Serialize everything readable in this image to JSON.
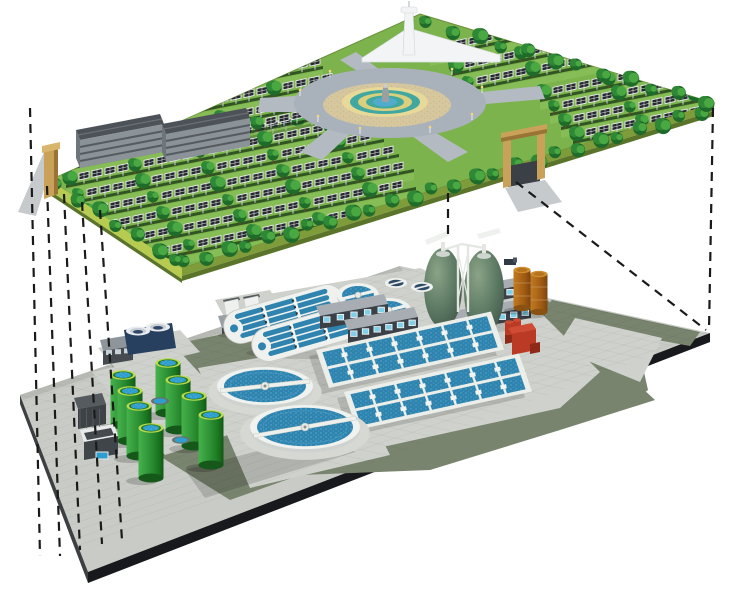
{
  "meta": {
    "description": "Isometric cutaway illustration: a solar park with trees, fountain plaza and greenhouses on an upper deck, with an underground wastewater treatment plant on a lower deck, linked by dashed projection lines",
    "text_content": "none - illustration contains no visible text"
  },
  "colors": {
    "sky": "#ffffff",
    "grass": "#7cb34c",
    "grassLight": "#90c55e",
    "rowShadow": "#1d3d18",
    "panel": "#25282e",
    "panelFrame": "#e9ebed",
    "post": "#cdd2d6",
    "treeDark": "#1e6b2a",
    "treeMid": "#2f8836",
    "treeLight": "#4aa843",
    "verge": "#a8c95e",
    "bevelLight": "#b7cb50",
    "bevelMid": "#7e9c3a",
    "bevelDark": "#5a7429",
    "plazaRing": "#a9b2bb",
    "path": "#b3bac1",
    "plazaTan": "#d6c79e",
    "plazaCream": "#e7d998",
    "plazaTeal": "#41a8a0",
    "plazaYellow": "#d9cf7d",
    "plazaBlue": "#52aacd",
    "fountainStone": "#9aa0a2",
    "roofDark": "#4c5257",
    "wallGray": "#8b9298",
    "windowBand": "#3a4045",
    "windowGlass": "#7fd0e8",
    "gateTan": "#c9a159",
    "gateTanDark": "#9a7436",
    "roadOut": "#c6cacd",
    "towerWhite": "#f2f4f5",
    "tile": "#c9ccc6",
    "road": "#79846f",
    "edgeBlack": "#17191c",
    "edgeGray": "#3c4043",
    "apron": "#cfd2cc",
    "curb": "#b7bab4",
    "white": "#eff1ee",
    "whiteShade": "#cfd3cf",
    "water": "#2e84ae",
    "waterDots": "#6db4d6",
    "waterDark": "#2f9ecf",
    "tankGreenRim": "#b9da4b",
    "tankInner": "#1f7a28",
    "tankBottom": "#15581a",
    "navy": "#27405f",
    "eggLight": "#8ba387",
    "egg": "#5d7a64",
    "eggDark": "#3f5546",
    "pipe": "#e3e7e2",
    "brown": "#aa6218",
    "brownDark": "#7c450e",
    "brownTop": "#cd8c2e",
    "red": "#bb3a26",
    "redDark": "#8f2a18",
    "redLight": "#d04b33",
    "shadow": "rgba(0,0,0,0.18)",
    "dash": "#1a1a1a"
  },
  "upper_deck": {
    "deck_polygon": [
      [
        50,
        180
      ],
      [
        420,
        14
      ],
      [
        714,
        103
      ],
      [
        182,
        268
      ]
    ],
    "solar_rows": [
      [
        128,
        96,
        195
      ],
      [
        140,
        112,
        200
      ],
      [
        152,
        128,
        205
      ],
      [
        164,
        144,
        210
      ],
      [
        430,
        46,
        175
      ],
      [
        452,
        64,
        175
      ],
      [
        464,
        80,
        180
      ],
      [
        58,
        160,
        300
      ],
      [
        66,
        176,
        305
      ],
      [
        74,
        192,
        310
      ],
      [
        84,
        208,
        315
      ],
      [
        94,
        224,
        320
      ],
      [
        106,
        240,
        310
      ],
      [
        120,
        256,
        240
      ],
      [
        540,
        90,
        168
      ],
      [
        550,
        104,
        166
      ],
      [
        561,
        118,
        160
      ],
      [
        573,
        132,
        148
      ],
      [
        340,
        226,
        130
      ]
    ],
    "row_slope": -0.2,
    "panel_spacing": 13,
    "tree_borders": [
      {
        "from": [
          186,
          263
        ],
        "to": [
          702,
          112
        ],
        "count": 26
      },
      {
        "from": [
          428,
          24
        ],
        "to": [
          704,
          102
        ],
        "count": 12
      },
      {
        "from": [
          58,
          186
        ],
        "to": [
          178,
          262
        ],
        "count": 7
      }
    ],
    "plaza": {
      "cx": 390,
      "cy": 103,
      "ring_rx": 96,
      "ring_ry": 35,
      "tan_rx": 64,
      "tan_ry": 22,
      "rings": [
        [
          43,
          15
        ],
        [
          35,
          12
        ],
        [
          27,
          9
        ],
        [
          19,
          6.5
        ],
        [
          12,
          4.5
        ]
      ],
      "lamps": [
        [
          300,
          96
        ],
        [
          318,
          122
        ],
        [
          360,
          134
        ],
        [
          430,
          133
        ],
        [
          472,
          120
        ],
        [
          482,
          93
        ],
        [
          452,
          75
        ],
        [
          330,
          77
        ]
      ]
    },
    "greenhouse_buildings": 2,
    "entrance_gates": 2,
    "observation_tower": true
  },
  "lower_deck": {
    "deck_polygon": [
      [
        20,
        395
      ],
      [
        400,
        266
      ],
      [
        710,
        333
      ],
      [
        88,
        572
      ]
    ],
    "green_tanks": [
      [
        168,
        363
      ],
      [
        123,
        375
      ],
      [
        178,
        380
      ],
      [
        130,
        391
      ],
      [
        194,
        396
      ],
      [
        139,
        406
      ],
      [
        211,
        415
      ],
      [
        151,
        428
      ]
    ],
    "clarifiers": [
      [
        265,
        386,
        48,
        19,
        -6
      ],
      [
        305,
        427,
        55,
        22,
        -10
      ]
    ],
    "oxidation_ditches": [
      [
        284,
        314,
        -16
      ],
      [
        312,
        332,
        -16
      ]
    ],
    "feed_tanks": [
      [
        358,
        295,
        21,
        12
      ],
      [
        389,
        310,
        22,
        12
      ]
    ],
    "covered_cells": [
      [
        396,
        283
      ],
      [
        422,
        287
      ]
    ],
    "aeration_basins": [
      [
        316,
        350
      ],
      [
        344,
        392
      ]
    ],
    "digester_eggs": [
      [
        443,
        288,
        19,
        40
      ],
      [
        484,
        292,
        20,
        42
      ]
    ],
    "fuel_tanks": [
      [
        522,
        270
      ],
      [
        539,
        274
      ]
    ],
    "service_buildings": 4,
    "red_pump_station": true,
    "small_pools": [
      [
        160,
        401
      ],
      [
        181,
        440
      ]
    ]
  },
  "projection_lines": {
    "dash_pattern": [
      9,
      7
    ],
    "segments": [
      [
        30,
        108,
        40,
        556
      ],
      [
        47,
        186,
        60,
        556
      ],
      [
        64,
        194,
        80,
        550
      ],
      [
        82,
        202,
        102,
        544
      ],
      [
        100,
        210,
        122,
        540
      ],
      [
        713,
        108,
        709,
        330
      ],
      [
        516,
        182,
        706,
        330
      ],
      [
        448,
        193,
        448,
        240
      ]
    ]
  }
}
